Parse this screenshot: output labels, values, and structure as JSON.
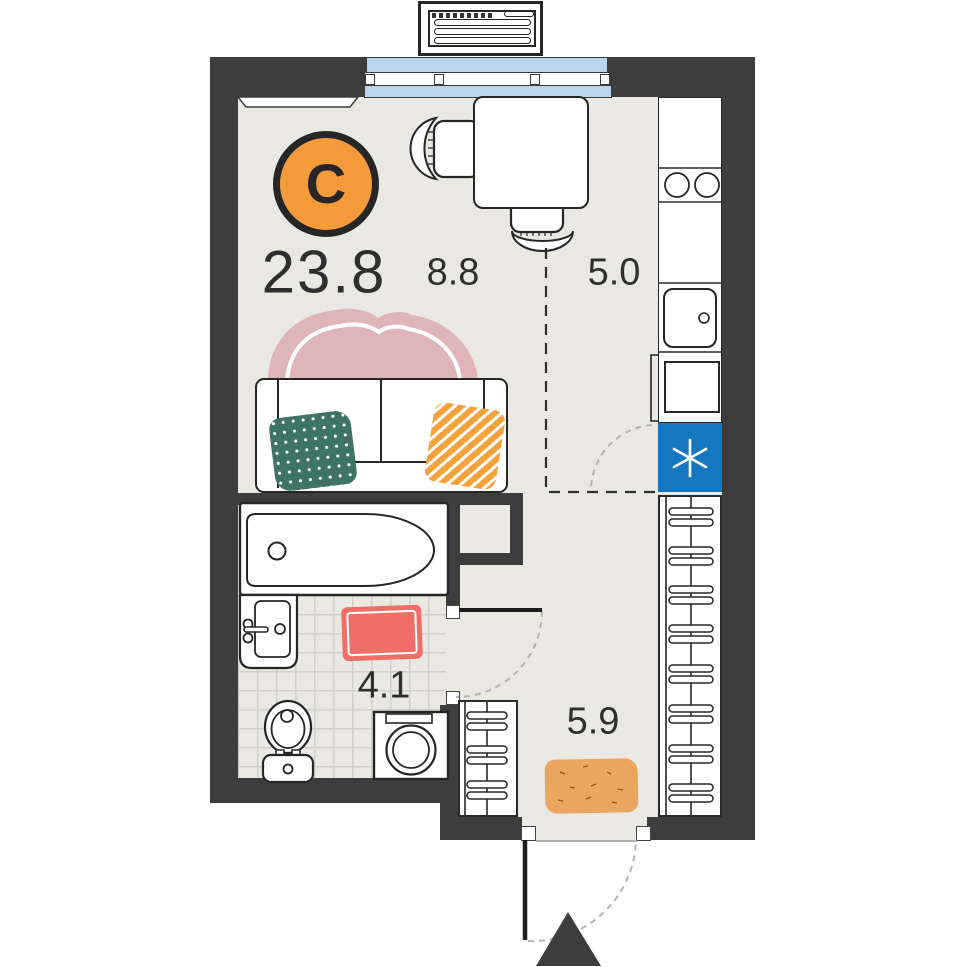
{
  "plan": {
    "total_area": "23.8",
    "compass": {
      "letter": "С"
    },
    "rooms": {
      "living": {
        "area": "8.8"
      },
      "kitchen": {
        "area": "5.0"
      },
      "bathroom": {
        "area": "4.1"
      },
      "hall": {
        "area": "5.9"
      }
    },
    "icons": {
      "refrigerator": "snowflake-asterisk-icon",
      "entrance": "entry-arrow-triangle-icon",
      "compass": "north-direction-badge"
    },
    "colors": {
      "wall": "#3d3d3d",
      "floor": "#e9e8e3",
      "glazing_blue": "#b9d5ee",
      "refrigerator_blue": "#1578be",
      "compass_orange": "#f49a3b",
      "pillow_teal": "#3e7366",
      "pillow_orange": "#f5a13c",
      "blanket_pink": "#dfb5b7",
      "bath_mat_red": "#ef6f68",
      "doormat_orange": "#eaa55f"
    }
  }
}
